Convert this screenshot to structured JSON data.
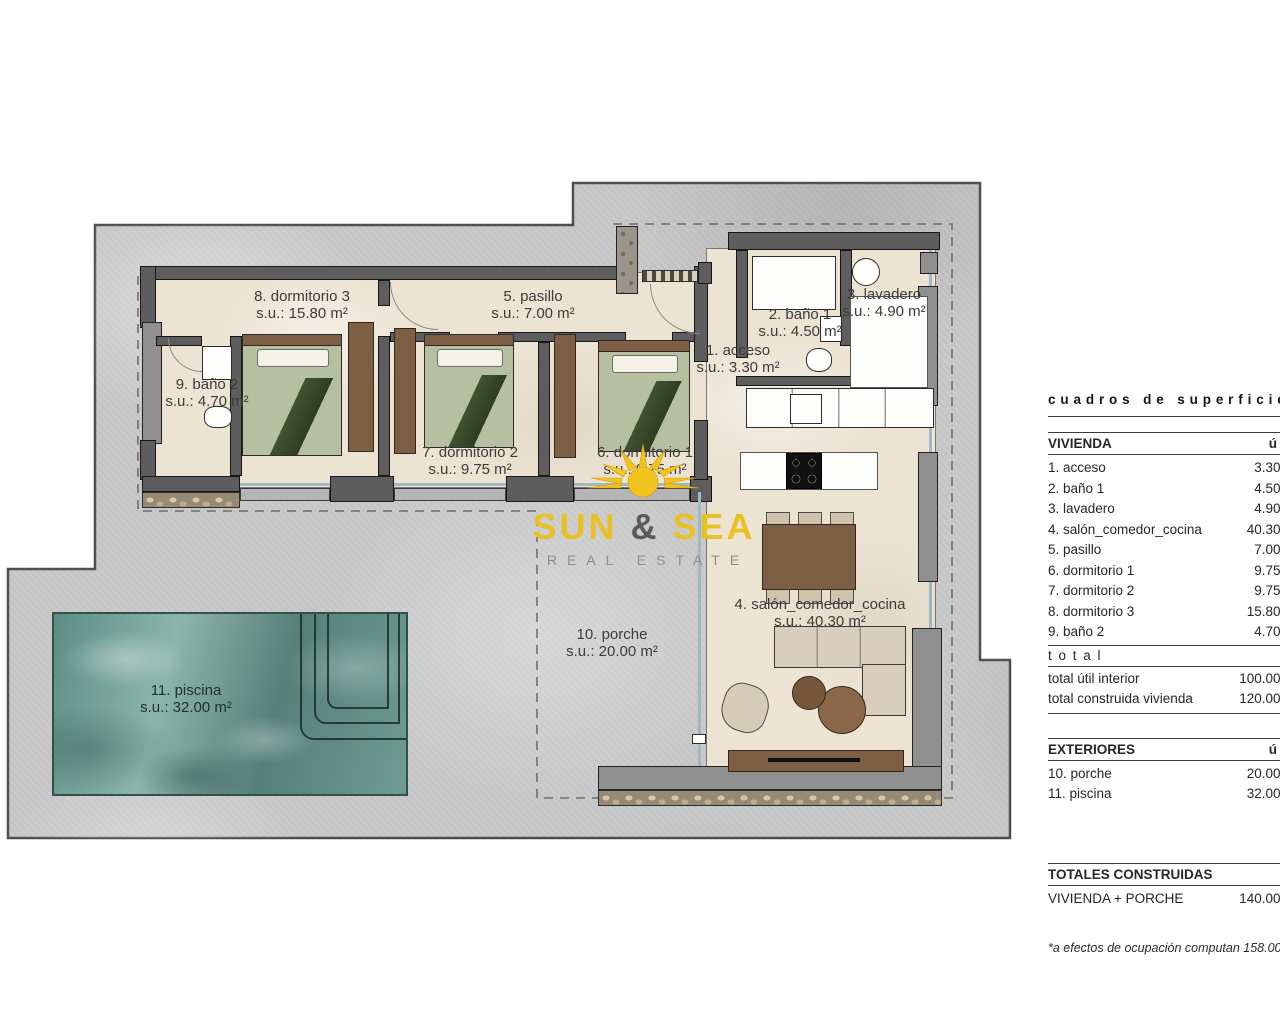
{
  "plan": {
    "rooms": [
      {
        "label": "8. dormitorio 3",
        "area": "s.u.: 15.80 m²"
      },
      {
        "label": "5. pasillo",
        "area": "s.u.: 7.00 m²"
      },
      {
        "label": "2. baño 1",
        "area": "s.u.: 4.50 m²"
      },
      {
        "label": "3. lavadero",
        "area": "s.u.: 4.90 m²"
      },
      {
        "label": "1. acceso",
        "area": "s.u.: 3.30 m²"
      },
      {
        "label": "9. baño 2",
        "area": "s.u.: 4.70 m²"
      },
      {
        "label": "7. dormitorio 2",
        "area": "s.u.: 9.75 m²"
      },
      {
        "label": "6. dormitorio 1",
        "area": "s.u.: 9.75 m²"
      },
      {
        "label": "4. salón_comedor_cocina",
        "area": "s.u.: 40.30 m²"
      },
      {
        "label": "10. porche",
        "area": "s.u.: 20.00 m²"
      },
      {
        "label": "11. piscina",
        "area": "s.u.: 32.00 m²"
      }
    ]
  },
  "logo": {
    "word1": "SUN",
    "ampersand": "&",
    "word2": "SEA",
    "tagline": "REAL ESTATE"
  },
  "table": {
    "title": "cuadros de superficie",
    "col_util": "útil",
    "vivienda": {
      "header": "VIVIENDA",
      "rows": [
        {
          "name": "1. acceso",
          "value": "3.30 m²"
        },
        {
          "name": "2. baño 1",
          "value": "4.50 m²"
        },
        {
          "name": "3. lavadero",
          "value": "4.90 m²"
        },
        {
          "name": "4. salón_comedor_cocina",
          "value": "40.30 m²"
        },
        {
          "name": "5. pasillo",
          "value": "7.00 m²"
        },
        {
          "name": "6. dormitorio 1",
          "value": "9.75 m²"
        },
        {
          "name": "7. dormitorio 2",
          "value": "9.75 m²"
        },
        {
          "name": "8. dormitorio 3",
          "value": "15.80 m²"
        },
        {
          "name": "9. baño 2",
          "value": "4.70 m²"
        }
      ],
      "total_label": "total",
      "totals": [
        {
          "name": "total útil interior",
          "value": "100.00 m²"
        },
        {
          "name": "total construida vivienda",
          "value": "120.00 m²"
        }
      ]
    },
    "exteriores": {
      "header": "EXTERIORES",
      "rows": [
        {
          "name": "10. porche",
          "value": "20.00 m²"
        },
        {
          "name": "11. piscina",
          "value": "32.00 m²"
        }
      ]
    },
    "totales": {
      "header": "TOTALES CONSTRUIDAS",
      "rows": [
        {
          "name": "VIVIENDA + PORCHE",
          "value": "140.00 m²"
        }
      ]
    },
    "footnote": "*a efectos de ocupación computan 158.00 m²"
  },
  "colors": {
    "plot_gray": "#c8c8c8",
    "floor_cream": "#ece3d3",
    "wall_dark": "#5d5d5d",
    "pool_teal": "#6f9b92",
    "wood_brown": "#7d5f45",
    "logo_yellow": "#e8c125"
  }
}
